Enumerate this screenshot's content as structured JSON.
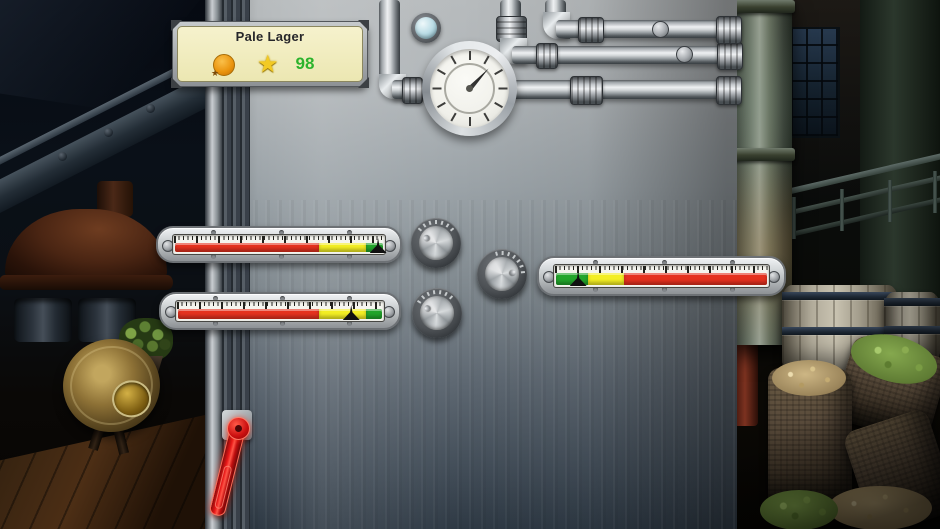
{
  "scene": {
    "name": "brewery-control-panel-game"
  },
  "recipe_panel": {
    "title": "Pale Lager",
    "score": "98",
    "score_color": "#2db32d",
    "star_glyph": "★",
    "medal_star_glyph": "★",
    "panel_fill": "#f3efc5"
  },
  "clock_gauge": {
    "tick_count": 12,
    "needle_transform": "rotate(43deg)"
  },
  "porthole": {
    "glass_color": "#bfdde6"
  },
  "linear_gauges": [
    {
      "id": "gauge-top-left",
      "zones": [
        {
          "name": "red",
          "color": "#e5321f",
          "width": "69%"
        },
        {
          "name": "yellow",
          "color": "#f3ee24",
          "width": "23%"
        },
        {
          "name": "green",
          "color": "#22a52b",
          "width": "8%"
        }
      ],
      "needle_left": "96.5%"
    },
    {
      "id": "gauge-bottom-left",
      "zones": [
        {
          "name": "red",
          "color": "#e5321f",
          "width": "69%"
        },
        {
          "name": "yellow",
          "color": "#f3ee24",
          "width": "23%"
        },
        {
          "name": "green",
          "color": "#22a52b",
          "width": "8%"
        }
      ],
      "needle_left": "84%"
    },
    {
      "id": "gauge-right",
      "zones": [
        {
          "name": "green",
          "color": "#22a52b",
          "width": "15%"
        },
        {
          "name": "yellow",
          "color": "#f3ee24",
          "width": "17%"
        },
        {
          "name": "red",
          "color": "#e5321f",
          "width": "68%"
        }
      ],
      "needle_left": "11%"
    }
  ],
  "knobs": [
    {
      "id": "knob-upper",
      "tick_count": 7,
      "tick_arc_center": 0,
      "tick_arc_span": 100,
      "indicator_transform": "rotate(-62deg) translateY(-11px)"
    },
    {
      "id": "knob-middle",
      "tick_count": 7,
      "tick_arc_center": 35,
      "tick_arc_span": 100,
      "indicator_transform": "rotate(84deg) translateY(-11px)"
    },
    {
      "id": "knob-lower",
      "tick_count": 7,
      "tick_arc_center": -8,
      "tick_arc_span": 100,
      "indicator_transform": "rotate(-64deg) translateY(-11px)"
    }
  ],
  "lever": {
    "color": "#e01414",
    "arm_transform": "rotate(14deg)"
  }
}
